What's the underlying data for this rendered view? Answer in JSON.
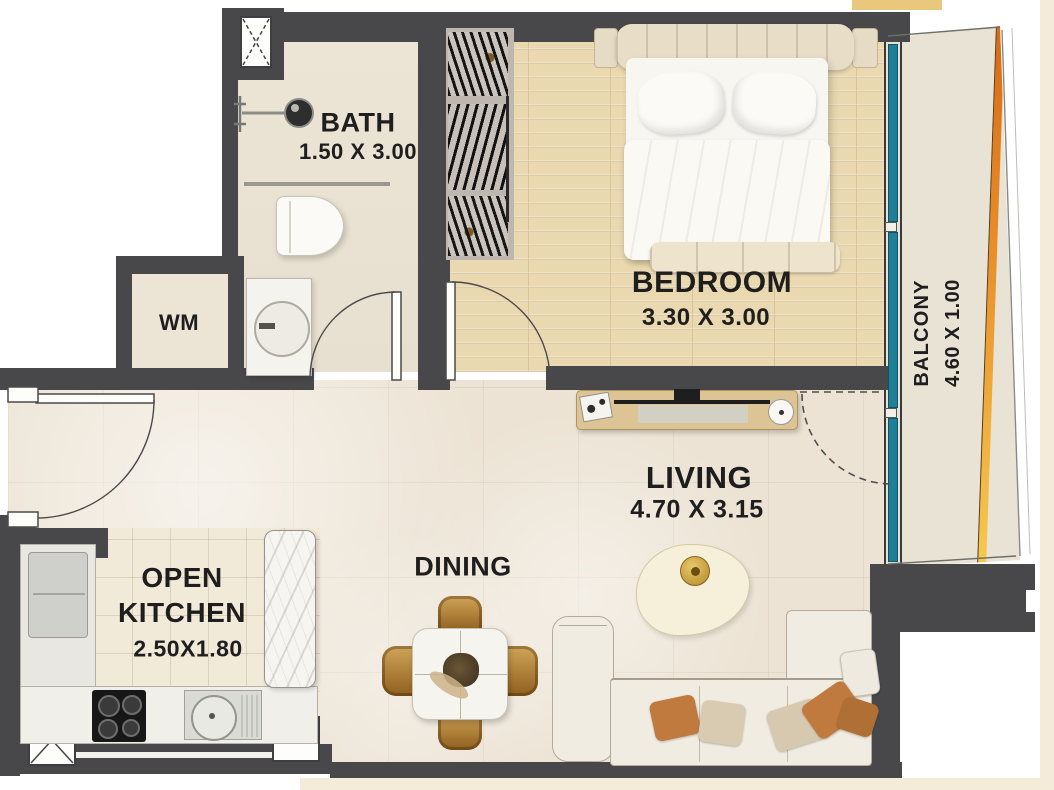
{
  "plan": {
    "title": "apartment-floor-plan",
    "rooms": {
      "bath": {
        "name": "BATH",
        "dims": "1.50 X 3.00"
      },
      "bedroom": {
        "name": "BEDROOM",
        "dims": "3.30 X 3.00"
      },
      "balcony": {
        "name": "BALCONY",
        "dims": "4.60 X 1.00"
      },
      "living": {
        "name": "LIVING",
        "dims": "4.70 X 3.15"
      },
      "dining": {
        "name": "DINING"
      },
      "kitchen": {
        "name_line1": "OPEN",
        "name_line2": "KITCHEN",
        "dims": "2.50X1.80"
      },
      "wm": {
        "name": "WM"
      }
    },
    "colors": {
      "wall": "#48484b",
      "wood_floor": "#ead8b0",
      "marble_floor": "#ece3d4",
      "kitchen_tile": "#f1ead9",
      "window_glass_teal": "#1f7f96",
      "balcony_rail_orange": "#d96a15",
      "balcony_rail_yellow": "#f6c94e",
      "corner_accent_tan": "#e9c87e",
      "chair_gold": "#b07b33"
    }
  }
}
